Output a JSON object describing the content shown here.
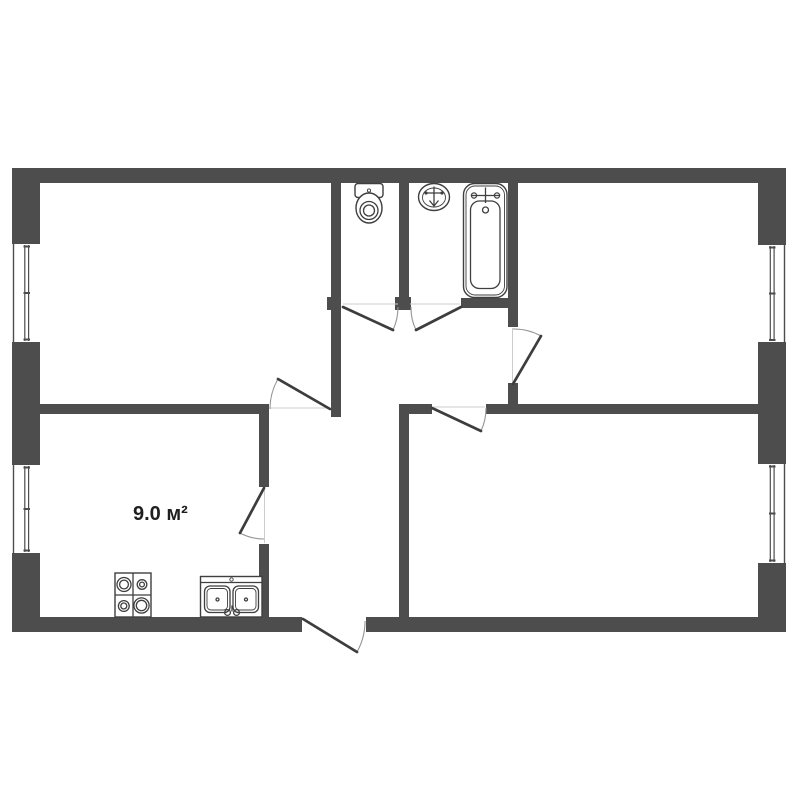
{
  "plan": {
    "area_label": "9.0 м²",
    "colors": {
      "background": "#ffffff",
      "wall": "#4d4d4d",
      "door_leaf": "#3d3d3d",
      "door_arc": "#949494",
      "threshold": "#cccccc",
      "fixture_line": "#3f3f3f",
      "label_text": "#1f1f1f"
    },
    "icons": [
      "toilet-icon",
      "washbasin-icon",
      "bathtub-icon",
      "stove-icon",
      "kitchen-sink-icon",
      "window-icon",
      "door-swing-icon"
    ]
  }
}
